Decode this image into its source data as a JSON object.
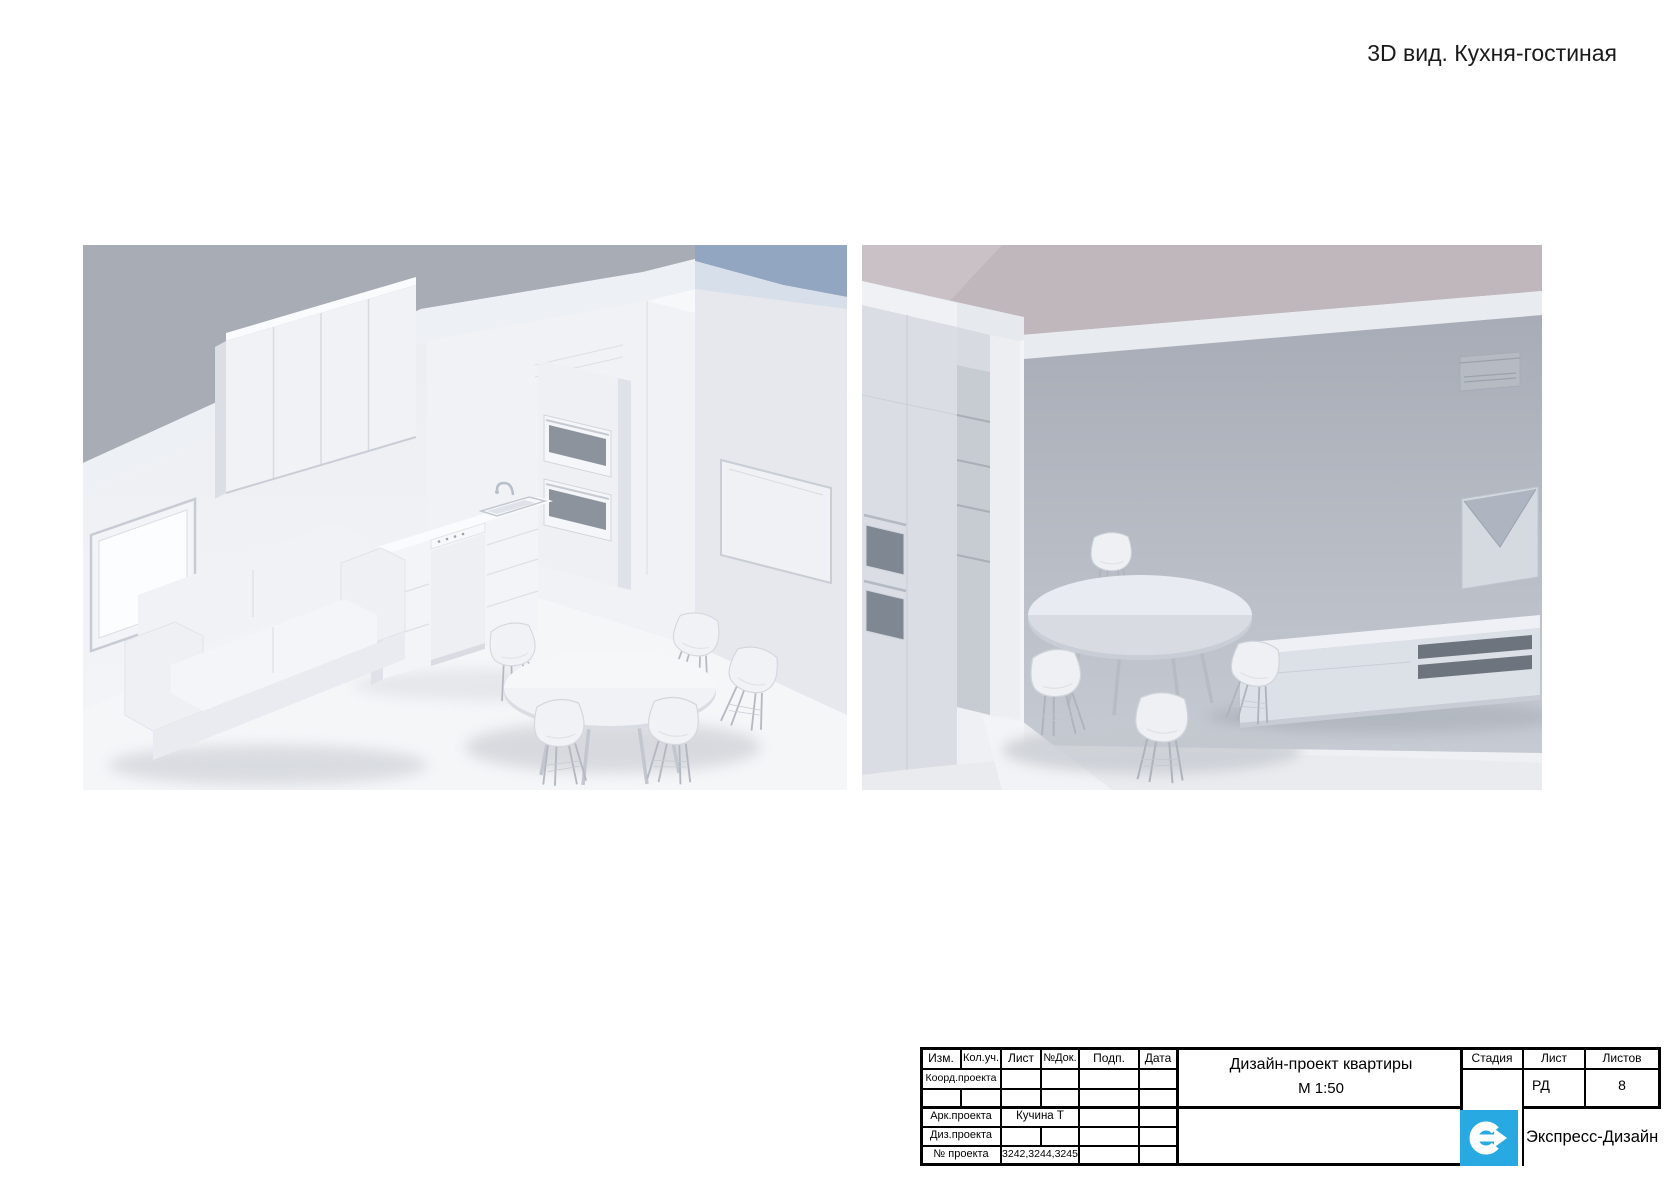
{
  "page": {
    "title": "3D вид. Кухня-гостиная"
  },
  "colors": {
    "logo_blue": "#29A9E1",
    "backdrop_gray": "#A8ACB4",
    "wall_gray": "#A9AEB7",
    "line_black": "#000000",
    "paper_white": "#FFFFFF"
  },
  "title_block": {
    "revision_headers": [
      "Изм.",
      "Кол.уч.",
      "Лист",
      "№Док.",
      "Подп.",
      "Дата"
    ],
    "rows": [
      {
        "label": "Коорд.проекта",
        "value": ""
      },
      {
        "label": "Арк.проекта",
        "value": "Кучина Т"
      },
      {
        "label": "Диз.проекта",
        "value": ""
      },
      {
        "label": "№ проекта",
        "value": "3242,3244,3245"
      }
    ],
    "project_title": "Дизайн-проект квартиры",
    "scale": "М 1:50",
    "stage_header": "Стадия",
    "sheet_header": "Лист",
    "sheets_header": "Листов",
    "stage_value": "",
    "sheet_value": "РД",
    "sheets_value": "8",
    "company": "Экспресс-Дизайн"
  }
}
